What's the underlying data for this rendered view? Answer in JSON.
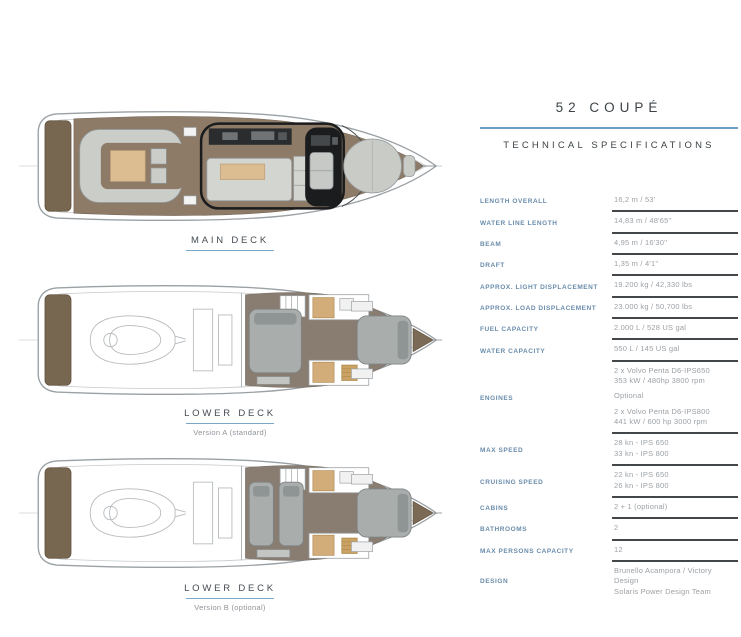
{
  "header": {
    "title": "52 COUPÉ",
    "subtitle": "TECHNICAL SPECIFICATIONS",
    "accent_color": "#6b9fc4"
  },
  "plans": [
    {
      "title": "MAIN DECK",
      "subtitle": ""
    },
    {
      "title": "LOWER DECK",
      "subtitle": "Version A (standard)"
    },
    {
      "title": "LOWER DECK",
      "subtitle": "Version B (optional)"
    }
  ],
  "specs": {
    "rows": [
      {
        "label": "LENGTH OVERALL",
        "lines": [
          "16,2 m / 53'"
        ],
        "rule": true
      },
      {
        "label": "WATER LINE LENGTH",
        "lines": [
          "14,83 m / 48'65''"
        ],
        "rule": true
      },
      {
        "label": "BEAM",
        "lines": [
          "4,95 m / 16'30''"
        ],
        "rule": true
      },
      {
        "label": "DRAFT",
        "lines": [
          "1,35 m / 4'1''"
        ],
        "rule": true
      },
      {
        "label": "APPROX. LIGHT DISPLACEMENT",
        "lines": [
          "19.200 kg / 42,330 lbs"
        ],
        "rule": true
      },
      {
        "label": "APPROX. LOAD DISPLACEMENT",
        "lines": [
          "23.000 kg / 50,700 lbs"
        ],
        "rule": true
      },
      {
        "label": "FUEL CAPACITY",
        "lines": [
          "2.000 L / 528 US gal"
        ],
        "rule": true
      },
      {
        "label": "WATER CAPACITY",
        "lines": [
          "550 L / 145 US gal"
        ],
        "rule": true
      },
      {
        "label": "ENGINES",
        "lines": [
          "2 x Volvo Penta D6-IPS650",
          "353 kW / 480hp 3800 rpm",
          "",
          "Optional",
          "",
          "2 x Volvo Penta D6-IPS800",
          "441 kW / 600 hp 3000 rpm"
        ],
        "rule": true
      },
      {
        "label": "MAX SPEED",
        "lines": [
          "28 kn - IPS 650",
          "33 kn - IPS 800"
        ],
        "rule": true
      },
      {
        "label": "CRUISING SPEED",
        "lines": [
          "22 kn - IPS 650",
          "26 kn - IPS 800"
        ],
        "rule": true
      },
      {
        "label": "CABINS",
        "lines": [
          "2 + 1 (optional)"
        ],
        "rule": true
      },
      {
        "label": "BATHROOMS",
        "lines": [
          "2"
        ],
        "rule": true
      },
      {
        "label": "MAX PERSONS CAPACITY",
        "lines": [
          "12"
        ],
        "rule": true
      },
      {
        "label": "DESIGN",
        "lines": [
          "Brunello Acampora / Victory Design",
          "Solaris Power Design Team"
        ],
        "rule": false
      }
    ]
  },
  "colors": {
    "accent_blue": "#6b9fc4",
    "label_blue": "#6a8cab",
    "value_gray": "#9ca1a6",
    "rule_dark": "#44474a",
    "deck_brown": "#8d7b67",
    "platform_brown": "#776650",
    "cushion_gray": "#cbcdc9",
    "table_tan": "#dcbd92",
    "floor_taupe": "#897d71",
    "helm_dark": "#1b1c1e"
  }
}
